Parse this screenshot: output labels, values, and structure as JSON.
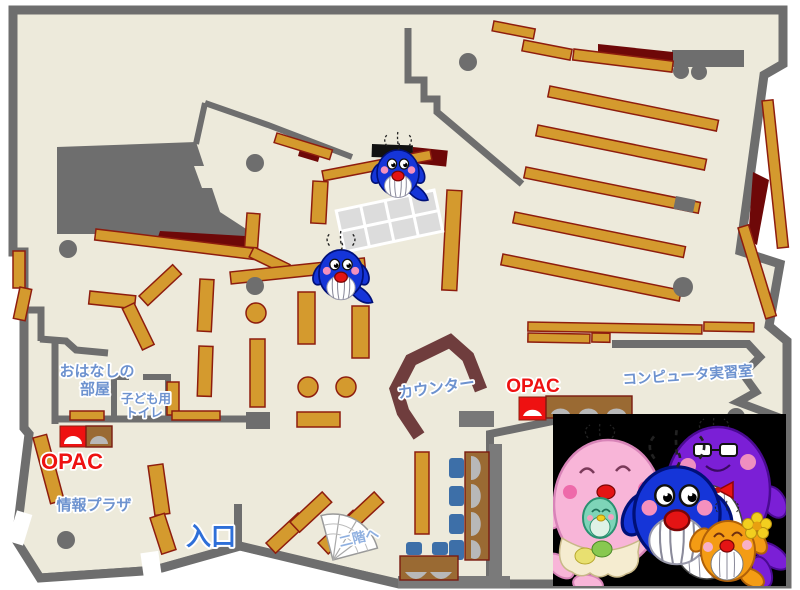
{
  "title": "library-floor-map",
  "labels": {
    "ohanashi_room_line1": "おはなしの",
    "ohanashi_room_line2": "部屋",
    "kids_toilet_line1": "子ども用",
    "kids_toilet_line2": "トイレ",
    "opac_left": "OPAC",
    "opac_right": "OPAC",
    "info_plaza": "情報プラザ",
    "entrance": "入口",
    "to_second_floor": "二階へ",
    "counter": "カウンター",
    "computer_room": "コンピュータ実習室"
  },
  "colors": {
    "floor": "#edeadb",
    "wall_gray": "#6e6e6e",
    "shelf_tan": "#d49a2e",
    "shelf_border": "#8e1d0e",
    "dark_red": "#6e0808",
    "opac_red": "#ee1111",
    "label_blue": "#6d92cf",
    "entrance_blue": "#2e6fd8",
    "light_blue": "#8fb0e0",
    "counter_brown": "#6f3d3d",
    "desk_brown": "#9a6a33",
    "seat_gray": "#b8b8b8",
    "chair_blue": "#3d6fa8",
    "panel_black": "#000000",
    "whale_blue": "#1535d8",
    "whale_pink": "#f8b5d8",
    "whale_purple": "#7b1fd6",
    "whale_orange": "#f49c14",
    "whale_teal": "#7ed4b8"
  },
  "mascots": {
    "map_whale_count": 2,
    "family_characters": [
      "pink mother whale with teal baby",
      "blue child whale",
      "purple father whale with glasses and bow tie",
      "orange small whale with flower"
    ]
  }
}
